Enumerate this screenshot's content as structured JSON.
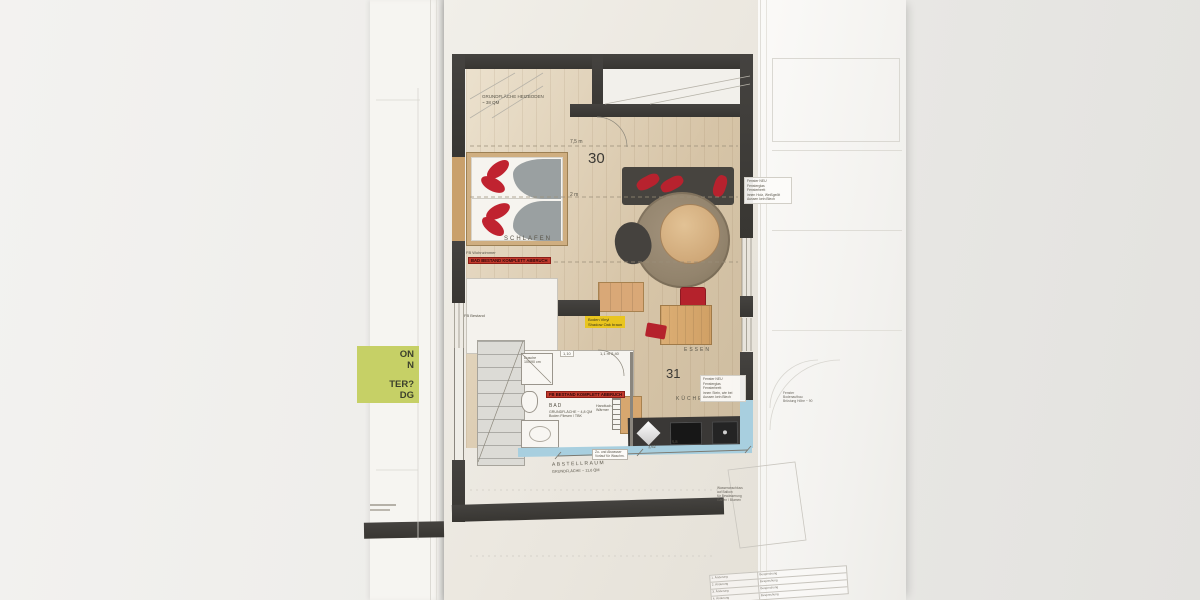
{
  "left_sheet": {
    "green_note_lines": [
      "ON",
      "N",
      "TER?",
      "DG"
    ]
  },
  "plan": {
    "heiz_note_l1": "GRUNDFLÄCHE HEIZBODEN",
    "heiz_note_l2": "~ 38 QM",
    "unit_top": "30",
    "unit_bottom": "31",
    "dim_top": "7,5 m",
    "dim_mid": "2 m",
    "dim_chip": "1,10",
    "dim_bath": "1,1 m   2,40",
    "dim_bottom_left": "3,62",
    "dim_bottom_right": "5,8",
    "room_schlafen": "SCHLAFEN",
    "room_essen": "ESSEN",
    "room_kueche": "KÜCHE",
    "room_bad": "BAD",
    "room_abstellraum": "ABSTELLRAUM",
    "abstell_area": "GRUNDFLÄCHE ~ 11,6 QM",
    "fb_wohnzimmer": "FB Wohnzimmer",
    "fb_bestand": "FB Bestand",
    "note_red_schlafen": "BAD BESTAND KOMPLETT ABBRUCH",
    "note_red_bad": "FB BESTAND KOMPLETT ABBRUCH",
    "note_yellow_l1": "Boden Vinyl",
    "note_yellow_l2": "Shadow Oak braun",
    "dusche_l1": "Dusche",
    "dusche_l2": "100/90 cm",
    "bad_area_l1": "GRUNDFLÄCHE ~ 4,8 QM",
    "bad_area_l2": "Boden Fliesen / TBK",
    "handtuch_l1": "Handtuch-",
    "handtuch_l2": "Wärmer",
    "abwasser_l1": "Zu- und Abwasser",
    "abwasser_l2": "Vorlauf für Waschm.",
    "fenster_note_a": [
      "Fenster NEU",
      "Fensterglas",
      "Fensterbrett",
      "innen Holz, Weißgeölt",
      "Aussen kein Blech"
    ],
    "fenster_note_b": [
      "Fenster NEU",
      "Fensterglas",
      "Fensterbrett",
      "innen Stein, wie bei",
      "Aussen kein Blech"
    ]
  },
  "right_sheet": {
    "fenster_small": [
      "Fenster",
      "Bodenaufbau",
      "Brüstung Höhe ~ 90"
    ],
    "balkon_note": [
      "Wasseranschluss",
      "auf Balkon",
      "für Bewässerung",
      "Garten / Blumen"
    ],
    "revisions": [
      {
        "name": "1. Änderung",
        "desc": "Besprechung"
      },
      {
        "name": "2. Änderung",
        "desc": "Besprechung"
      },
      {
        "name": "3. Änderung",
        "desc": "Besprechung"
      },
      {
        "name": "4. Änderung",
        "desc": "Besprechung"
      }
    ]
  },
  "colors": {
    "wall_dark": "#3f3d3a",
    "accent_red": "#b5222c",
    "highlight_yellow": "#e9c51f",
    "highlight_green": "#c6d066",
    "window_blue": "#a8cfdf",
    "wood": "#d8b488"
  }
}
